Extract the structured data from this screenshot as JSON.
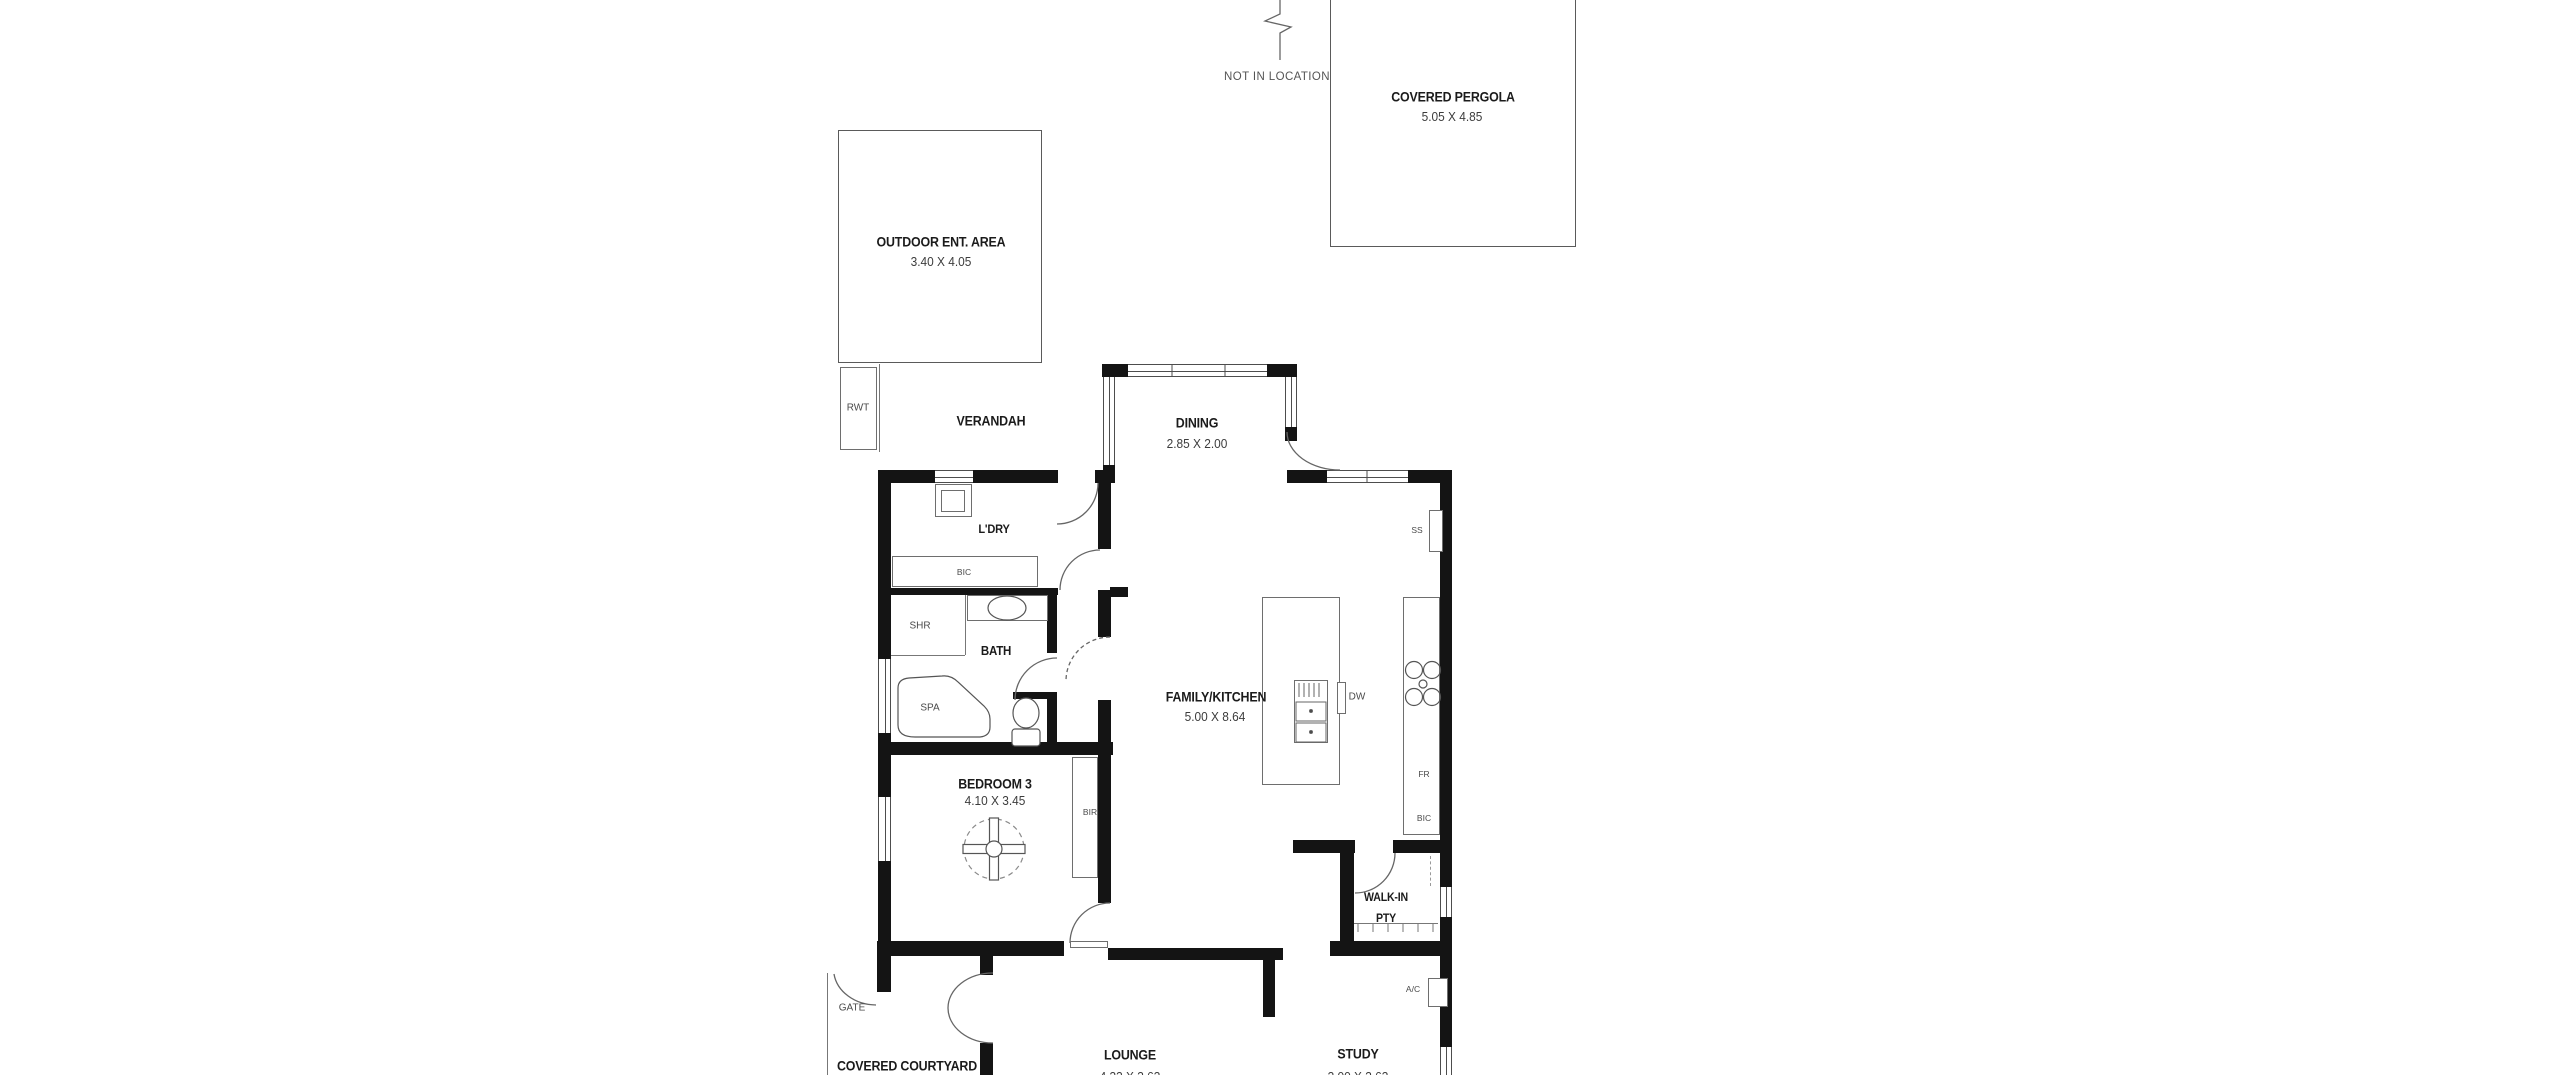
{
  "annotations": {
    "not_in_location": "NOT IN LOCATION"
  },
  "areas": {
    "covered_pergola": {
      "label": "COVERED PERGOLA",
      "dims": "5.05 X 4.85"
    },
    "outdoor_ent": {
      "label": "OUTDOOR ENT. AREA",
      "dims": "3.40 X 4.05"
    },
    "verandah": {
      "label": "VERANDAH"
    },
    "dining": {
      "label": "DINING",
      "dims": "2.85 X 2.00"
    },
    "ldry": {
      "label": "L'DRY"
    },
    "bath": {
      "label": "BATH"
    },
    "bedroom3": {
      "label": "BEDROOM 3",
      "dims": "4.10 X 3.45"
    },
    "family_kitchen": {
      "label": "FAMILY/KITCHEN",
      "dims": "5.00 X 8.64"
    },
    "walkin_pantry": {
      "label_line1": "WALK-IN",
      "label_line2": "PTY"
    },
    "lounge": {
      "label": "LOUNGE",
      "dims": "4.33 X 3.63"
    },
    "study": {
      "label": "STUDY",
      "dims": "3.00 X 3.63"
    },
    "covered_courtyard": {
      "label": "COVERED COURTYARD"
    },
    "gate": {
      "label": "GATE"
    }
  },
  "fixtures": {
    "rwt": "RWT",
    "bic_laundry": "BIC",
    "shr": "SHR",
    "spa": "SPA",
    "bir": "BIR",
    "ss": "SS",
    "dw": "DW",
    "fr": "FR",
    "bic_kitchen": "BIC",
    "ac": "A/C"
  },
  "colors": {
    "wall": "#141414",
    "line": "#5a5a5a",
    "text": "#1b1b1b",
    "background": "#ffffff"
  }
}
